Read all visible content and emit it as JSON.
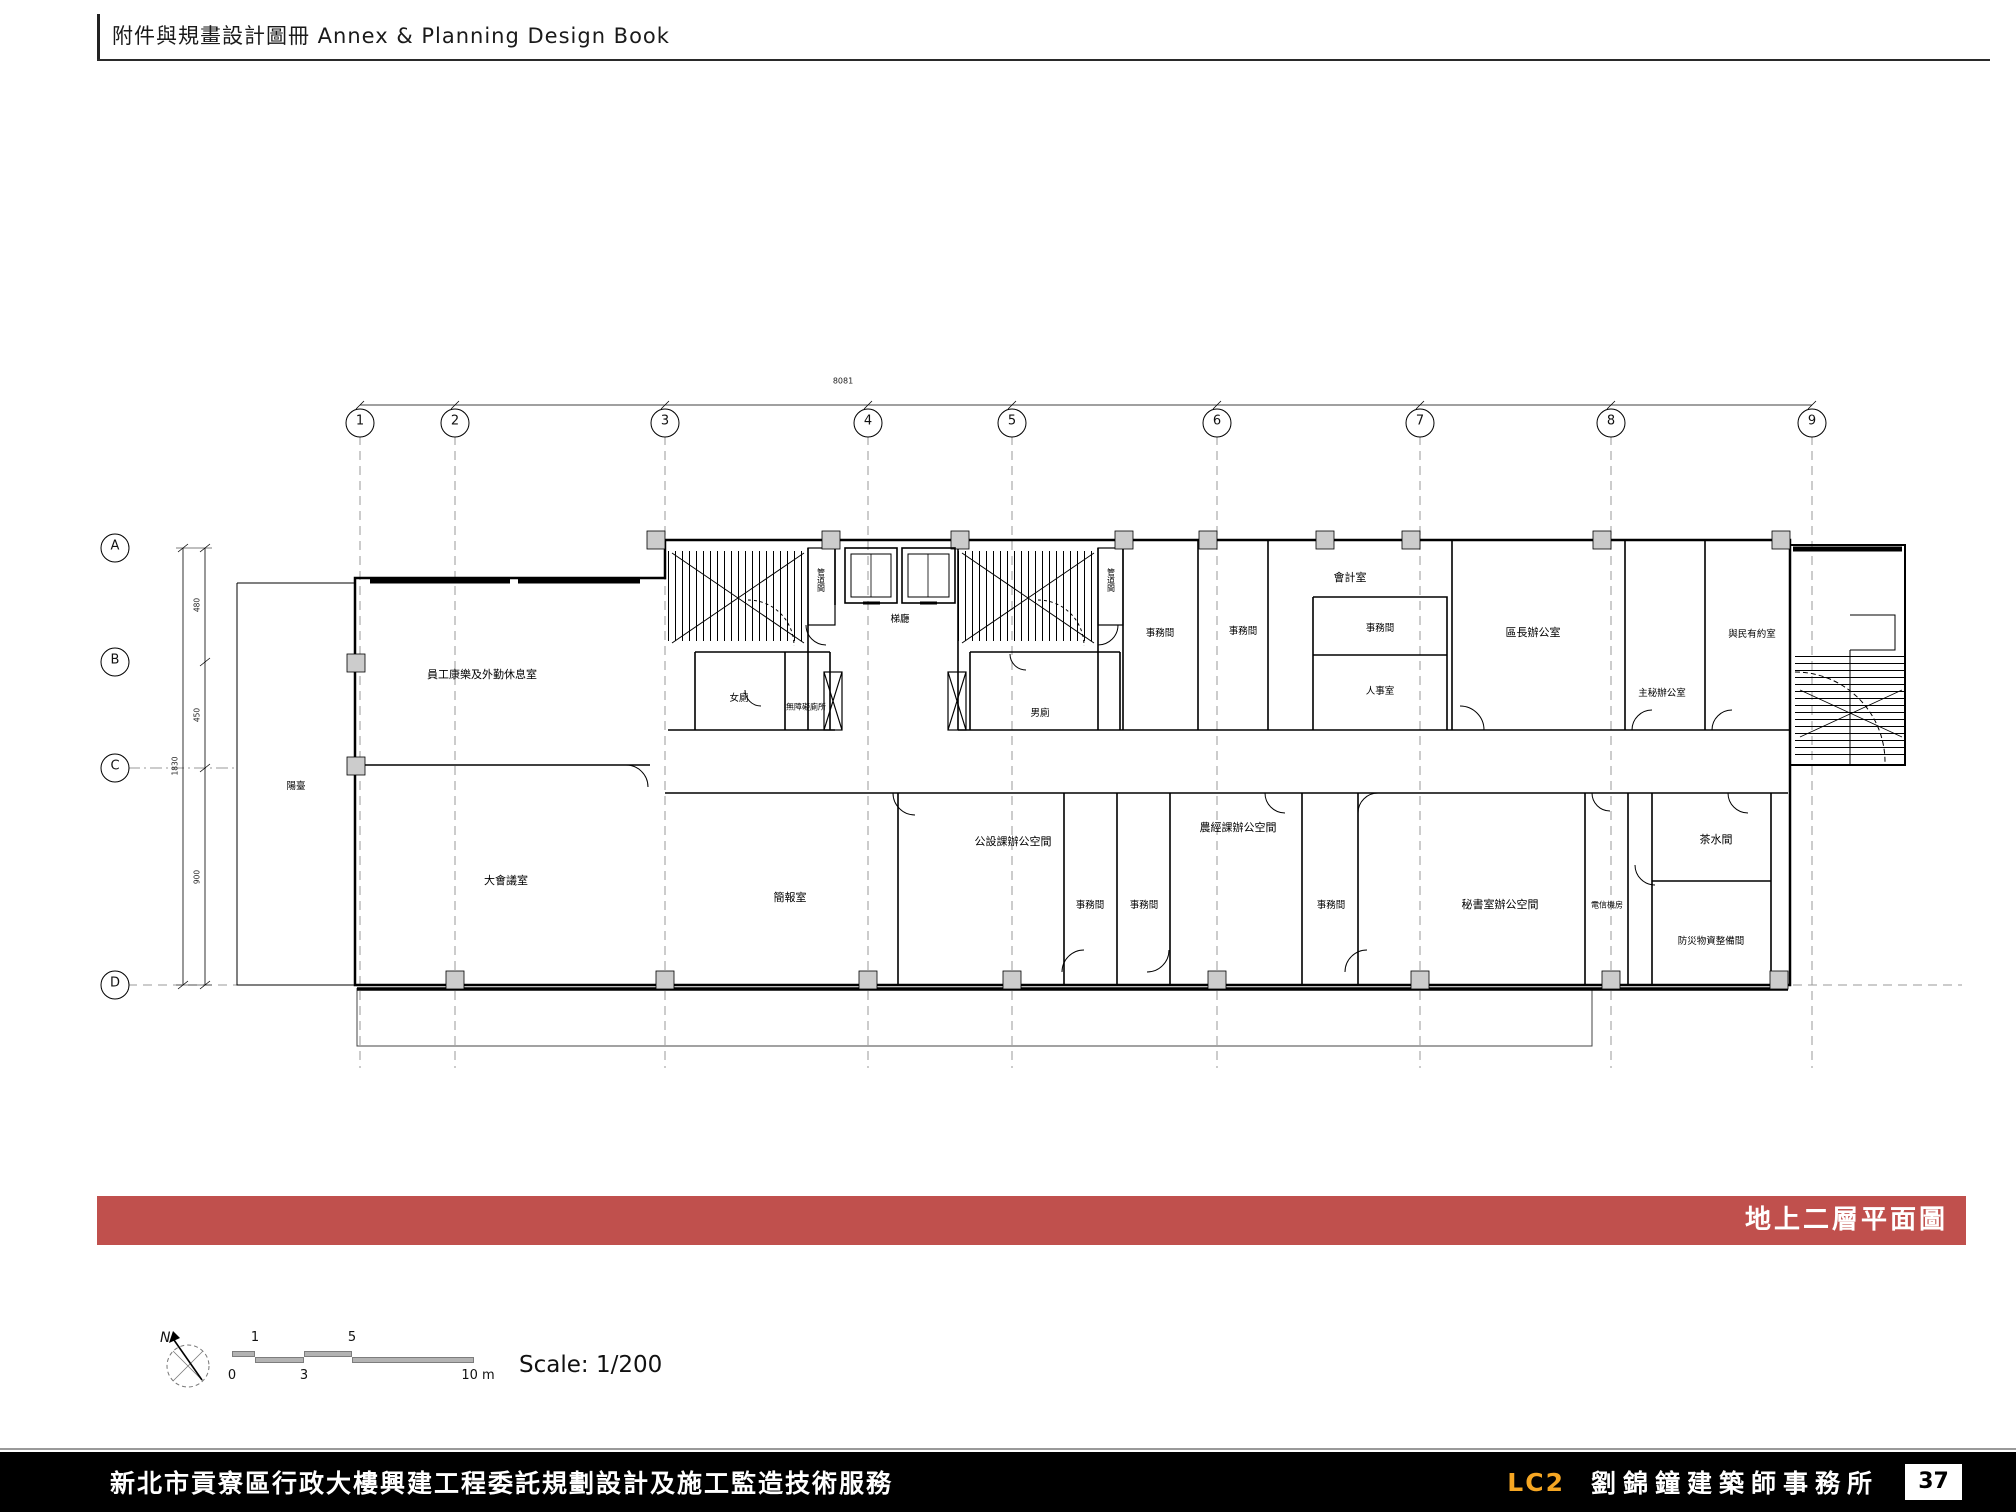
{
  "header": {
    "title": "附件與規畫設計圖冊 Annex & Planning Design Book"
  },
  "banner": {
    "label": "地上二層平面圖",
    "color": "#c0504d"
  },
  "grid": {
    "columns": [
      "1",
      "2",
      "3",
      "4",
      "5",
      "6",
      "7",
      "8",
      "9"
    ],
    "rows": [
      "A",
      "B",
      "C",
      "D"
    ]
  },
  "dimensions": {
    "left_segments": [
      "480",
      "450",
      "900"
    ],
    "left_total": "1830",
    "top_total": "8081"
  },
  "rooms": {
    "balcony": "陽臺",
    "staff_lounge": "員工康樂及外勤休息室",
    "large_conference": "大會議室",
    "briefing": "簡報室",
    "womens_toilet": "女廁",
    "accessible_toilet": "無障礙廁所",
    "mens_toilet": "男廁",
    "elevator_hall": "梯廳",
    "pipe_shaft_left": "管道間",
    "pipe_shaft_right": "管道間",
    "office_a": "事務間",
    "office_b": "事務間",
    "accounting": "會計室",
    "office_c": "事務間",
    "personnel": "人事室",
    "district_chief": "區長辦公室",
    "chief_secretary": "主秘辦公室",
    "citizen_meeting": "與民有約室",
    "civil_section": "公設課辦公空間",
    "office_d": "事務間",
    "office_e": "事務間",
    "agri_econ_section": "農經課辦公空間",
    "office_f": "事務間",
    "secretariat": "秘書室辦公空間",
    "telecom_room": "電信機房",
    "pantry": "茶水間",
    "disaster_supplies": "防災物資整備間"
  },
  "scale_info": {
    "north_label": "N",
    "scale_label": "Scale: 1/200",
    "bar_numbers_top": [
      "1",
      "5"
    ],
    "bar_numbers_bottom": [
      "0",
      "3",
      "10 m"
    ]
  },
  "footer": {
    "project": "新北市貢寮區行政大樓興建工程委託規劃設計及施工監造技術服務",
    "firm_code": "LC2",
    "firm_name": "劉錦鐘建築師事務所",
    "page_number": "37",
    "accent_color": "#f5a623"
  }
}
